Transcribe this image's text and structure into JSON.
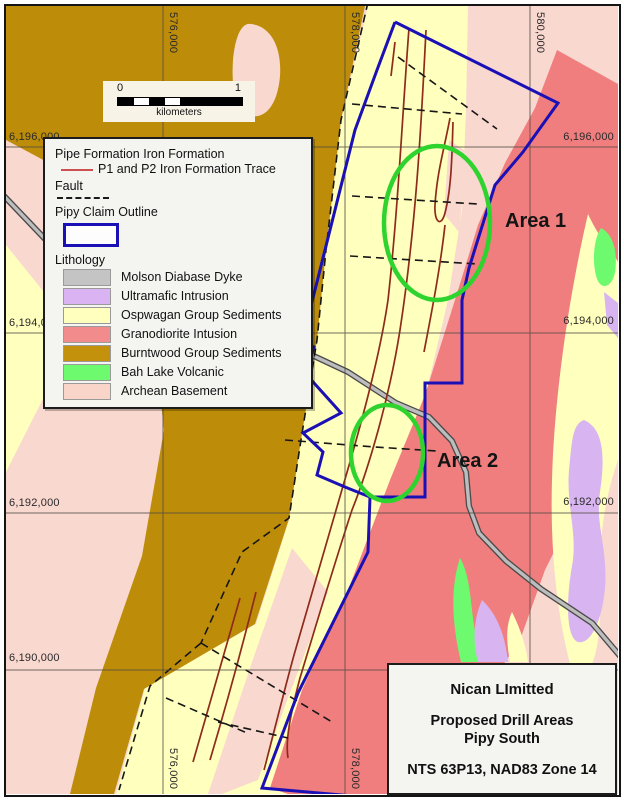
{
  "map": {
    "area_labels": {
      "area1": "Area 1",
      "area2": "Area 2"
    }
  },
  "legend": {
    "iron_formation_heading": "Pipe Formation Iron Formation",
    "iron_formation_trace_label": "P1 and P2 Iron Formation Trace",
    "fault_label": "Fault",
    "claim_outline_label": "Pipy Claim Outline",
    "lithology_heading": "Lithology",
    "lithology": [
      {
        "label": "Molson Diabase Dyke",
        "color": "#c4c4c4"
      },
      {
        "label": "Ultramafic Intrusion",
        "color": "#d9b3f2"
      },
      {
        "label": "Ospwagan Group Sediments",
        "color": "#ffffbe"
      },
      {
        "label": "Granodiorite Intusion",
        "color": "#f28b8b"
      },
      {
        "label": "Burntwood Group Sediments",
        "color": "#c3910b"
      },
      {
        "label": "Bah Lake Volcanic",
        "color": "#6efa6e"
      },
      {
        "label": "Archean Basement",
        "color": "#f9d4c9"
      }
    ]
  },
  "scale_bar": {
    "start": "0",
    "end": "1",
    "unit": "kilometers"
  },
  "title_block": {
    "company": "Nican LImitted",
    "subtitle_line1": "Proposed Drill Areas",
    "subtitle_line2": "Pipy South",
    "reference": "NTS 63P13, NAD83 Zone 14"
  },
  "grid": {
    "top_labels": {
      "x576": "576,000",
      "x578": "578,000",
      "x580": "580,000"
    },
    "bottom_labels": {
      "x576": "576,000",
      "x578": "578,000"
    },
    "left_labels": {
      "y6196": "6,196,000",
      "y6194": "6,194,000",
      "y6192": "6,192,000",
      "y6190": "6,190,000"
    },
    "right_labels": {
      "y6196": "6,196,000",
      "y6194": "6,194,000",
      "y6192": "6,192,000"
    }
  },
  "colors": {
    "claim_outline": "#1b10b5",
    "trace_legend_line": "#cc5050",
    "area_circle": "#2ed32e",
    "iron_trace": "#8f2b1b",
    "archean_pink": "#f9d8cf",
    "burntwood_gold": "#bd8c09",
    "granodiorite_red": "#f07e7e",
    "ospwagan_yellow": "#ffffbe"
  }
}
